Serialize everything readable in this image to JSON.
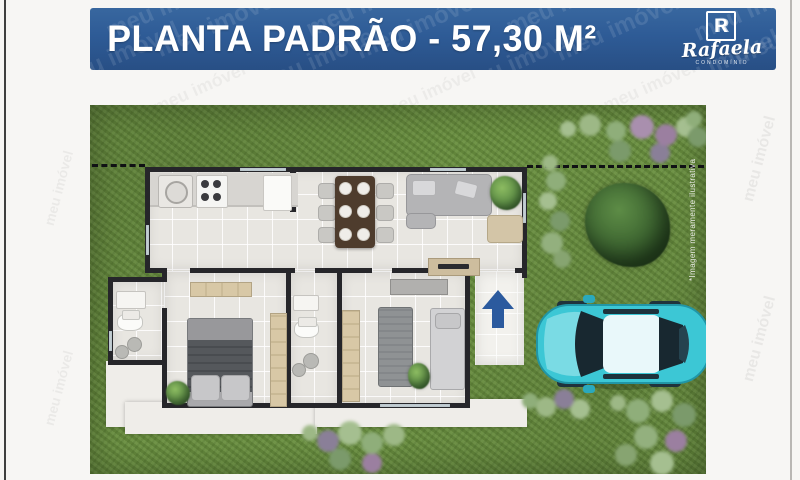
{
  "banner": {
    "title": "PLANTA PADRÃO - 57,30 M²",
    "bg_color": "#2e5b96"
  },
  "logo": {
    "monogram": "R",
    "name": "Rafaela",
    "subtitle": "CONDOMÍNIO"
  },
  "watermark": {
    "text": "meu imóvel"
  },
  "plan": {
    "disclaimer": "*Imagem meramente ilustrativa",
    "colors": {
      "grass": "#6c9142",
      "floor_tile": "#e8e6e1",
      "wall": "#26262a",
      "sidewalk": "#efede9",
      "entrance_arrow": "#2b5a9e",
      "car_body": "#3cc7d5",
      "banner_blue": "#2e5b96"
    }
  }
}
